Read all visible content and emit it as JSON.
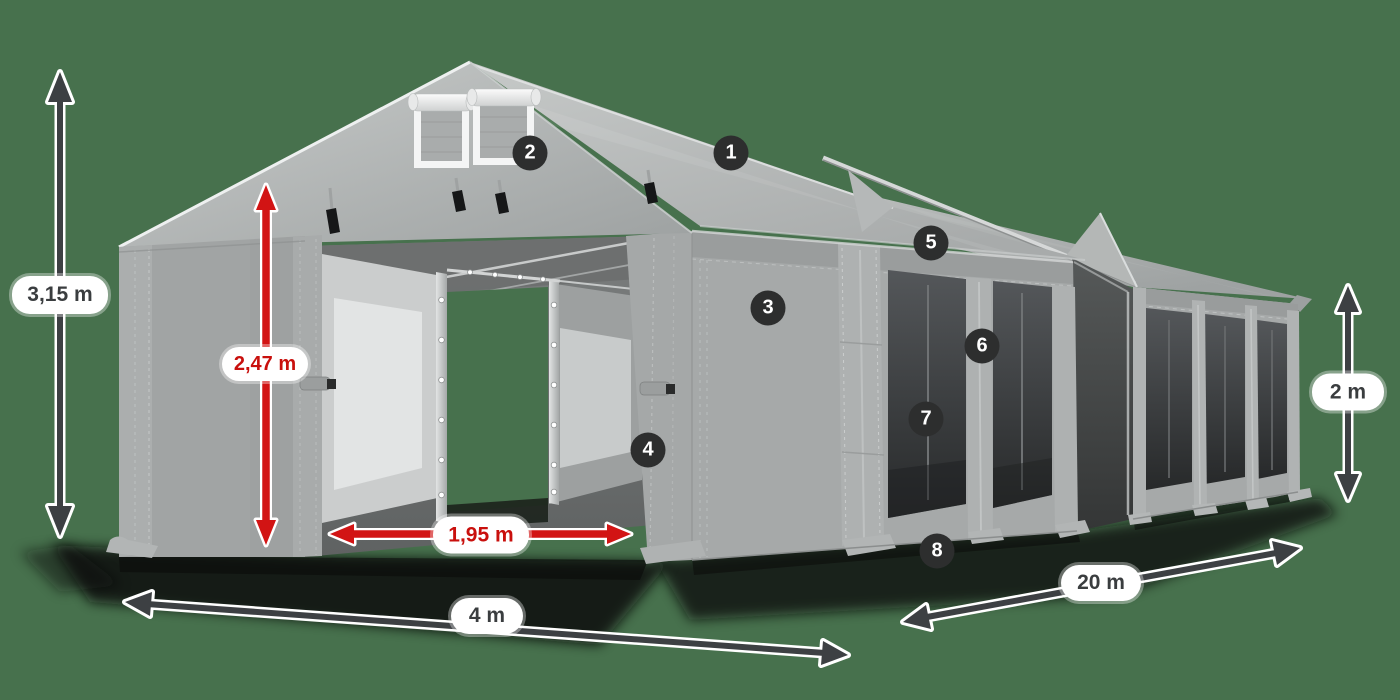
{
  "colors": {
    "bg": "#47714d",
    "tent-gray": "#a6a9a9",
    "mesh-dark": "#2b2d2e",
    "arrow-dark": "#3d4043",
    "arrow-red": "#d21414",
    "badge-bg": "#2d2e2e",
    "label-text": "#3a3d3f",
    "label-red": "#c9100d"
  },
  "dimensions": {
    "total_height": {
      "label": "3,15 m"
    },
    "door_height": {
      "label": "2,47 m"
    },
    "door_width": {
      "label": "1,95 m"
    },
    "span_width": {
      "label": "4 m"
    },
    "length": {
      "label": "20 m"
    },
    "wall_height": {
      "label": "2 m"
    }
  },
  "callouts": [
    {
      "number": "1"
    },
    {
      "number": "2"
    },
    {
      "number": "3"
    },
    {
      "number": "4"
    },
    {
      "number": "5"
    },
    {
      "number": "6"
    },
    {
      "number": "7"
    },
    {
      "number": "8"
    }
  ]
}
